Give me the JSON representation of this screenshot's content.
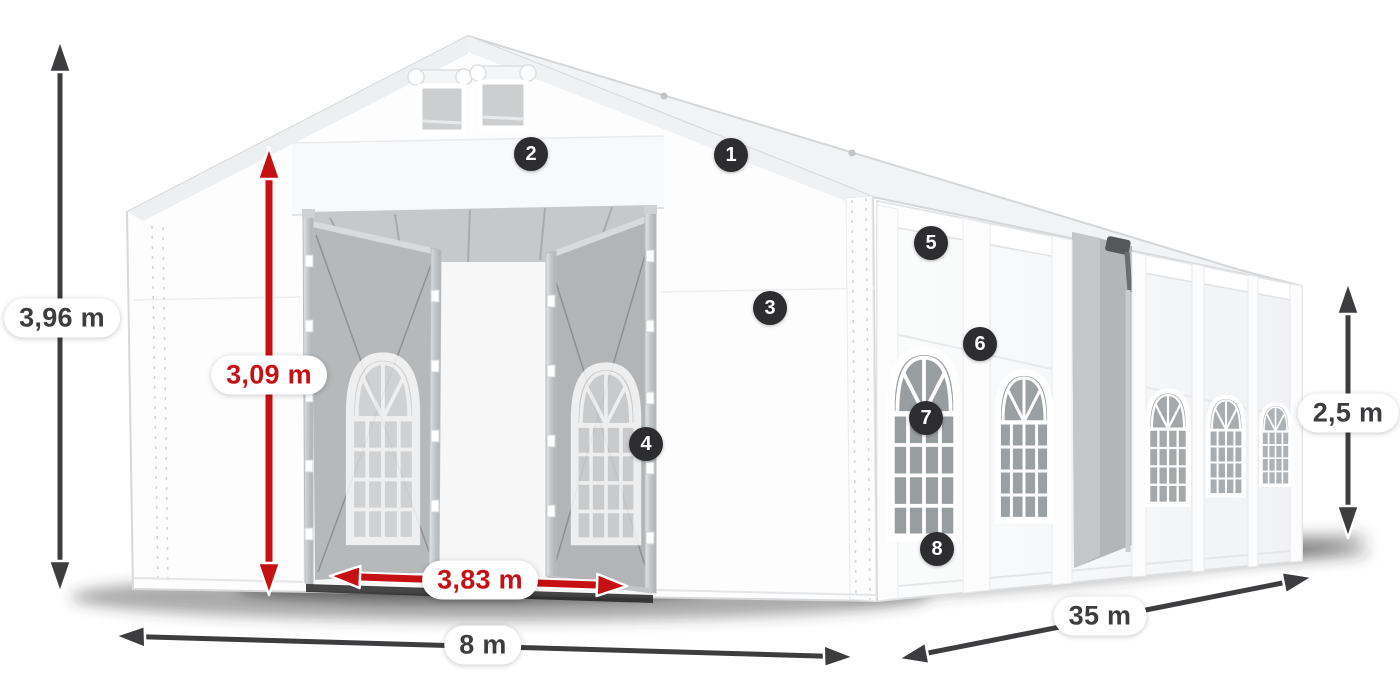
{
  "diagram": {
    "name": "party-tent-dimensions-diagram",
    "description": "White marquee tent shown in perspective with numbered part markers and dimension arrows"
  },
  "dimensions": {
    "total_height": "3,96 m",
    "entrance_height": "3,09 m",
    "entrance_width": "3,83 m",
    "gable_width": "8 m",
    "length": "35 m",
    "side_height": "2,5 m"
  },
  "markers": [
    "1",
    "2",
    "3",
    "4",
    "5",
    "6",
    "7",
    "8"
  ],
  "colors": {
    "dimension_primary": "#3d3d3f",
    "dimension_accent": "#c51113",
    "marker_background": "#2d2d2f",
    "marker_text": "#ffffff",
    "label_background": "#ffffff",
    "page_background": "#ffffff"
  }
}
